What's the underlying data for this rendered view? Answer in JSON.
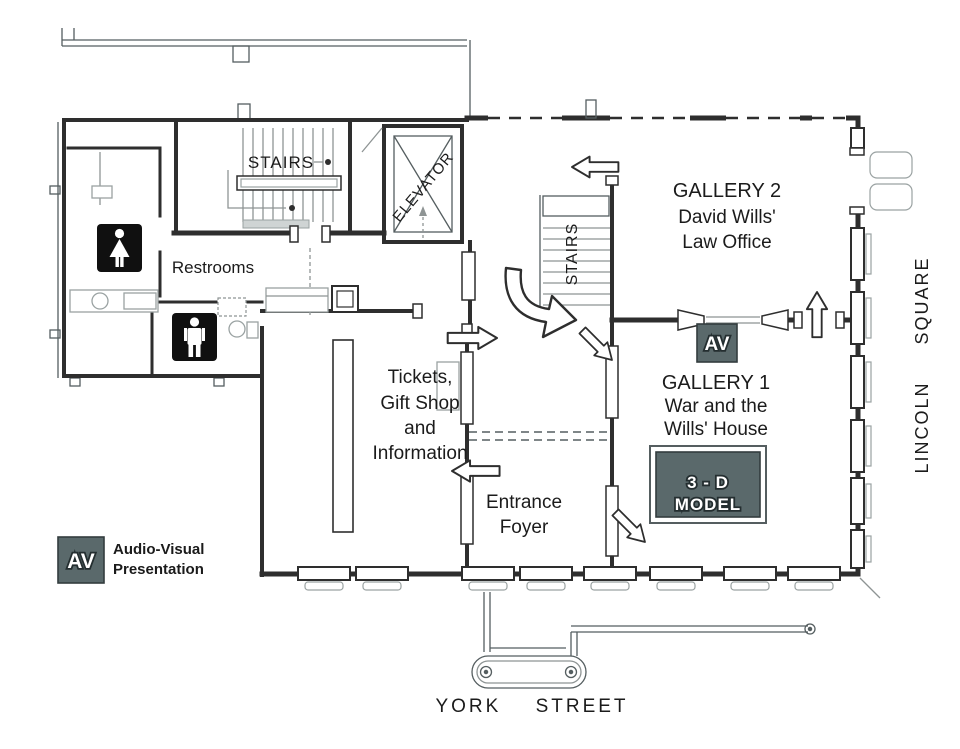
{
  "rooms": {
    "stairs_north": {
      "label": "STAIRS"
    },
    "stairs_central": {
      "label": "STAIRS"
    },
    "elevator": {
      "label": "ELEVATOR"
    },
    "restrooms": {
      "label": "Restrooms"
    },
    "gallery_2": {
      "name": "GALLERY 2",
      "desc_line1": "David Wills'",
      "desc_line2": "Law Office"
    },
    "gallery_1": {
      "name": "GALLERY 1",
      "desc_line1": "War and the",
      "desc_line2": "Wills' House"
    },
    "tickets": {
      "line1": "Tickets,",
      "line2": "Gift Shop",
      "line3": "and",
      "line4": "Information"
    },
    "entrance_foyer": {
      "line1": "Entrance",
      "line2": "Foyer"
    }
  },
  "exhibits": {
    "model_3d": {
      "line1": "3 - D",
      "line2": "MODEL"
    },
    "av_marker": {
      "label": "AV"
    }
  },
  "legend": {
    "av_abbrev": "AV",
    "label_line1": "Audio-Visual",
    "label_line2": "Presentation"
  },
  "streets": {
    "east_vertical": "LINCOLN SQUARE",
    "south": "YORK STREET"
  },
  "colors": {
    "wall": "#2e2e2e",
    "wall_light": "#8e9494",
    "marker_box": "#5a696b",
    "icon_background": "#101010",
    "text": "#1b1b1b",
    "background": "#ffffff"
  }
}
